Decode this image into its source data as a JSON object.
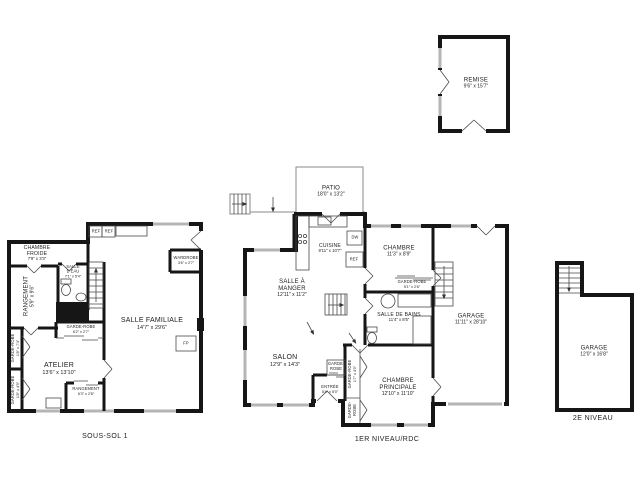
{
  "colors": {
    "background": "#ffffff",
    "wall": "#161616",
    "thin_line": "#4a4a4a",
    "window_gray": "#b5b5b5",
    "text": "#1d1d1d"
  },
  "plans": {
    "sous_sol": {
      "floor_label": "SOUS-SOL 1",
      "rooms": {
        "chambre_froide": {
          "name": "CHAMBRE FROIDE",
          "dims": "7'9\" x 3'3\""
        },
        "rangement_left": {
          "name": "RANGEMENT",
          "dims": "5'9\" x 9'6\""
        },
        "salle_deau": {
          "name": "SALLE D'EAU",
          "dims": "7'1\" x 5'4\""
        },
        "ref1": {
          "name": "REF"
        },
        "ref2": {
          "name": "REF"
        },
        "wardrobe": {
          "name": "WARDROBE",
          "dims": "3'6\" x 2'7\""
        },
        "salle_familiale": {
          "name": "SALLE FAMILIALE",
          "dims": "14'7\" x 29'6\""
        },
        "fireplace": {
          "name": "FP"
        },
        "garde_robe_mid": {
          "name": "GARDE-ROBE",
          "dims": "6'2\" x 2'7\""
        },
        "garde_robe_left": {
          "name": "GARDE-ROBE",
          "dims": "1'8\" x 7'4\""
        },
        "atelier": {
          "name": "ATELIER",
          "dims": "13'6\" x 13'10\""
        },
        "garde_robe_bottom_left": {
          "name": "GARDE-ROBE",
          "dims": "1'8\" x 4'9\""
        },
        "rangement_bottom": {
          "name": "RANGEMENT",
          "dims": "6'3\" x 2'8\""
        }
      }
    },
    "rdc": {
      "floor_label": "1ER NIVEAU/RDC",
      "rooms": {
        "patio": {
          "name": "PATIO",
          "dims": "18'0\" x 13'2\""
        },
        "cuisine": {
          "name": "CUISINE",
          "dims": "9'11\" x 10'7\""
        },
        "dw": {
          "name": "DW"
        },
        "ref": {
          "name": "REF"
        },
        "chambre": {
          "name": "CHAMBRE",
          "dims": "11'3\" x 8'9\""
        },
        "salle_a_manger": {
          "name": "SALLE À MANGER",
          "dims": "12'11\" x 11'2\""
        },
        "garde_robe_chambre": {
          "name": "GARDE-ROBE",
          "dims": "5'1\" x 2'6\""
        },
        "salle_de_bains": {
          "name": "SALLE DE BAINS",
          "dims": "11'4\" x 8'5\""
        },
        "salon": {
          "name": "SALON",
          "dims": "12'9\" x 14'3\""
        },
        "entree": {
          "name": "ENTRÉE",
          "dims": "5'4\" x 5'0\""
        },
        "garde_robe_entree": {
          "name": "GARDE-ROBE"
        },
        "garde_robe_couloir": {
          "name": "GARDE-ROBE",
          "dims": "1'7\" x 4'0\""
        },
        "garde_robe_couloir2": {
          "name": "GARDE-ROBE"
        },
        "chambre_principale": {
          "name": "CHAMBRE PRINCIPALE",
          "dims": "12'10\" x 11'10\""
        },
        "garage": {
          "name": "GARAGE",
          "dims": "11'11\" x 28'10\""
        }
      }
    },
    "remise": {
      "rooms": {
        "remise": {
          "name": "REMISE",
          "dims": "9'6\" x 15'7\""
        }
      }
    },
    "niveau2": {
      "floor_label": "2E NIVEAU",
      "rooms": {
        "garage": {
          "name": "GARAGE",
          "dims": "12'0\" x 16'8\""
        }
      }
    }
  }
}
